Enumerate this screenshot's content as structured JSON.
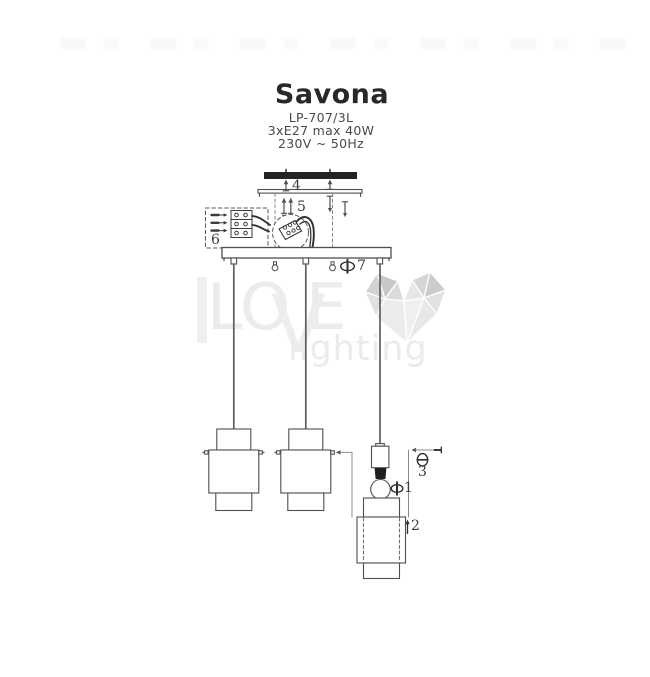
{
  "product": {
    "title": "Savona",
    "model": "LP-707/3L",
    "power": "3xE27 max 40W",
    "voltage": "230V ~ 50Hz"
  },
  "diagram": {
    "type": "assembly-instruction",
    "part_labels": {
      "p1": "1",
      "p2": "2",
      "p3": "3",
      "p4": "4",
      "p5": "5",
      "p6": "6",
      "p7": "7"
    },
    "parts_semantics": {
      "p1": "shade-locking-screw",
      "p2": "shade-slide-direction",
      "p3": "side-screw",
      "p4": "bracket-screws",
      "p5": "canopy-screws",
      "p6": "terminal-block-wiring",
      "p7": "cord-grip-screw"
    }
  },
  "watermark": {
    "letters": [
      "L",
      "O",
      "V",
      "E"
    ],
    "word": "lighting",
    "logo": "polygonal-heart"
  },
  "colors": {
    "line": "#4f4f4f",
    "dark_fill": "#26221e",
    "watermark_text": "#ececec",
    "heart_dark": "#c9c9c9",
    "heart_light": "#ececec",
    "background": "#ffffff"
  }
}
